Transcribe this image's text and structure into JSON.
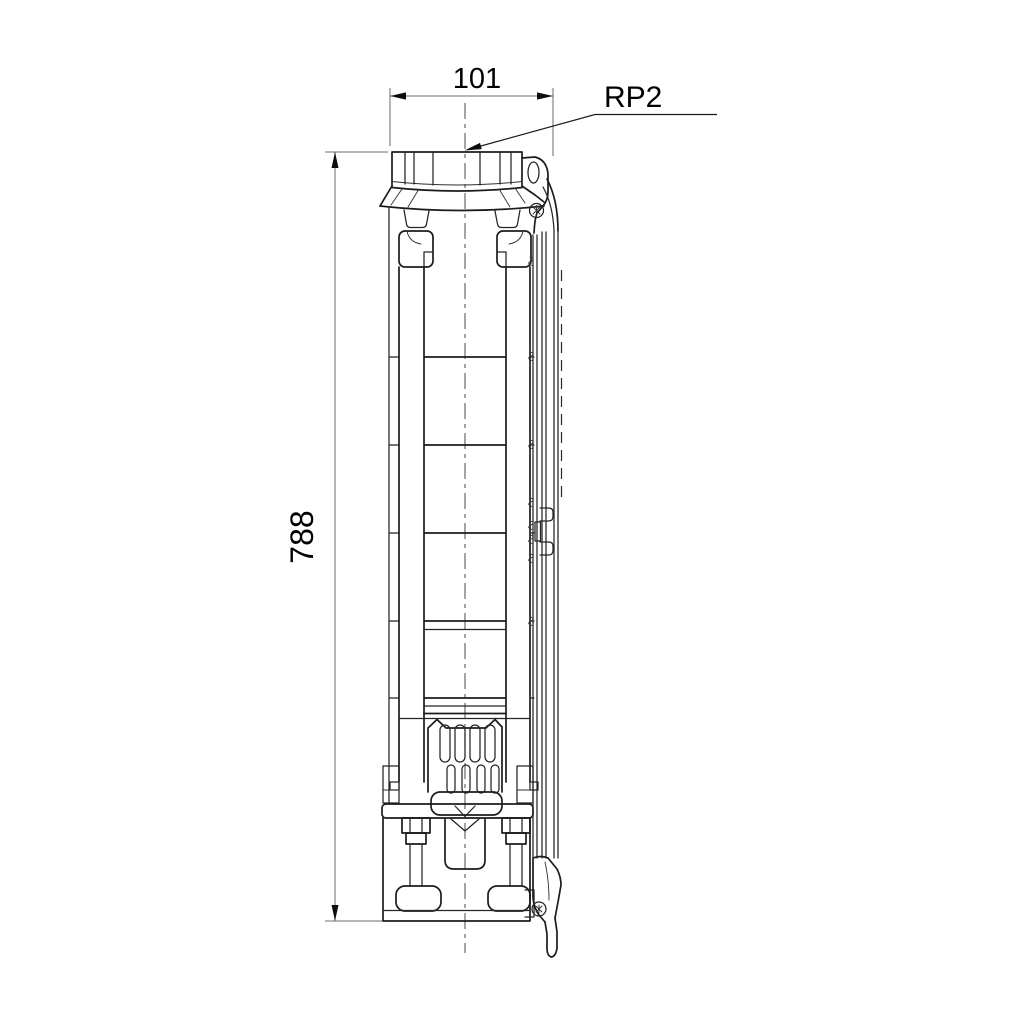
{
  "drawing": {
    "type": "technical-dimensional-drawing",
    "subject": "submersible borehole pump - side elevation",
    "background_color": "#ffffff",
    "outline_color": "#1c1c1c",
    "dimension_line_color": "#6f6f6f",
    "text_color": "#000000",
    "width_dimension": {
      "value": "101",
      "orientation": "horizontal",
      "position": "top"
    },
    "height_dimension": {
      "value": "788",
      "orientation": "vertical",
      "position": "left"
    },
    "connection_label": {
      "text": "RP2",
      "points_to": "discharge-port-thread"
    }
  }
}
